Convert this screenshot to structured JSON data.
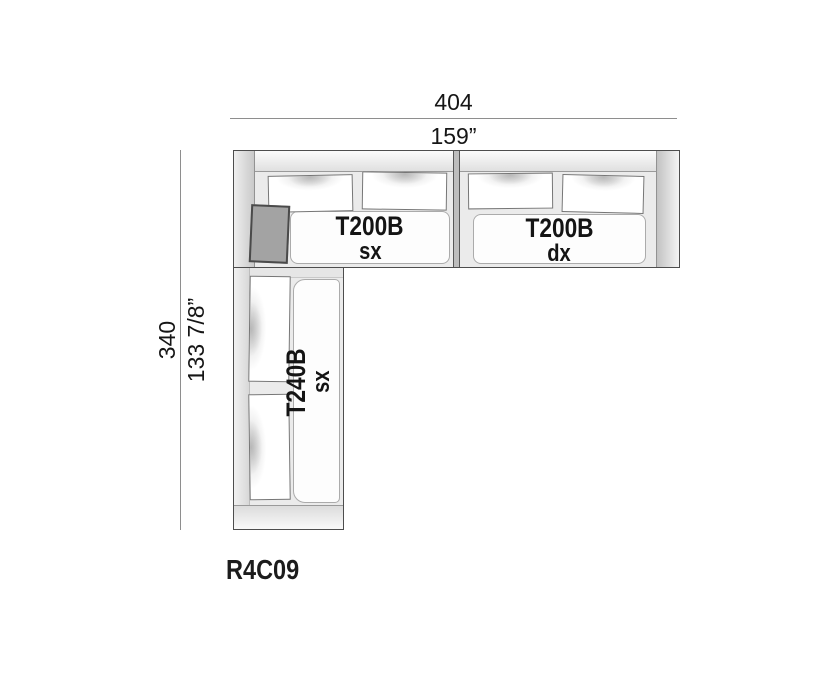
{
  "product": {
    "code": "R4C09"
  },
  "dimensions": {
    "width_cm": "404",
    "width_in": "159”",
    "depth_cm": "340",
    "depth_in": "133 7/8”"
  },
  "modules": [
    {
      "id": "t200b-sx",
      "label": "T200B",
      "variant": "sx"
    },
    {
      "id": "t200b-dx",
      "label": "T200B",
      "variant": "dx"
    },
    {
      "id": "t240b-sx",
      "label": "T240B",
      "variant": "sx"
    }
  ],
  "colors": {
    "outline": "#4d4d4d",
    "body_fill": "#ebebeb",
    "seat_fill": "#fdfdfd",
    "corner_cushion": "#a3a3a3",
    "dim_line": "#8e8e8e",
    "text": "#161616"
  }
}
